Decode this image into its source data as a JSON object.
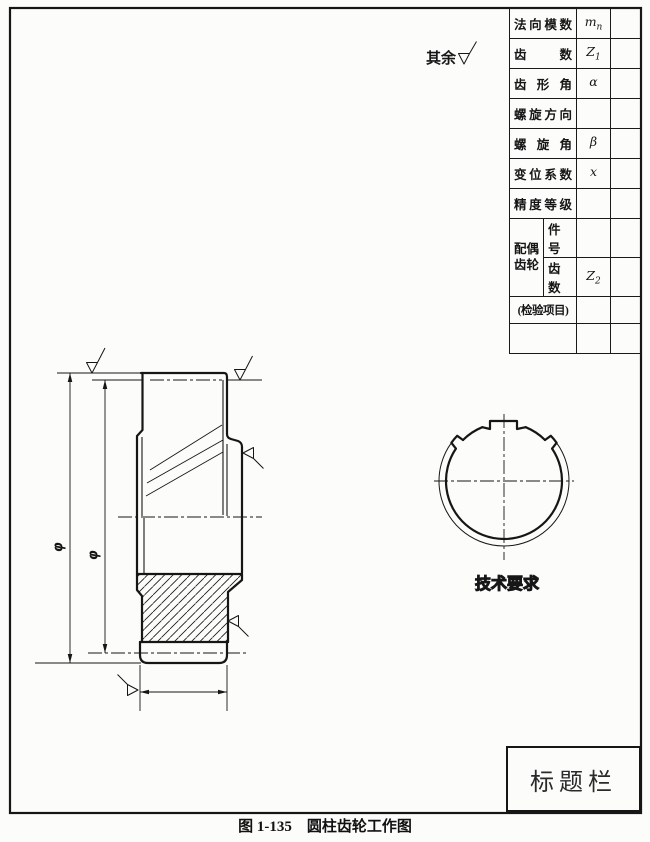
{
  "page": {
    "caption": "图 1-135　圆柱齿轮工作图"
  },
  "annotations": {
    "surface_note": "其余",
    "tech_requirements": "技术要求",
    "dim_phi_outer": "φ",
    "dim_phi_pitch": "φ"
  },
  "title_block": {
    "label": "标题栏"
  },
  "param_table": {
    "rows": [
      {
        "label": "法向模数",
        "sym_base": "m",
        "sym_sub": "n",
        "value": ""
      },
      {
        "label": "齿数",
        "sym_base": "Z",
        "sym_sub": "1",
        "value": ""
      },
      {
        "label": "齿形角",
        "sym_base": "α",
        "sym_sub": "",
        "value": ""
      },
      {
        "label": "螺旋方向",
        "sym_base": "",
        "sym_sub": "",
        "value": ""
      },
      {
        "label": "螺旋角",
        "sym_base": "β",
        "sym_sub": "",
        "value": ""
      },
      {
        "label": "变位系数",
        "sym_base": "x",
        "sym_sub": "",
        "value": ""
      },
      {
        "label": "精度等级",
        "sym_base": "",
        "sym_sub": "",
        "value": ""
      }
    ],
    "mate_gear": {
      "group_label": "配偶齿轮",
      "rows": [
        {
          "label": "件号",
          "sym_base": "",
          "sym_sub": "",
          "value": ""
        },
        {
          "label": "齿数",
          "sym_base": "Z",
          "sym_sub": "2",
          "value": ""
        }
      ]
    },
    "inspection_label": "(检验项目)"
  }
}
